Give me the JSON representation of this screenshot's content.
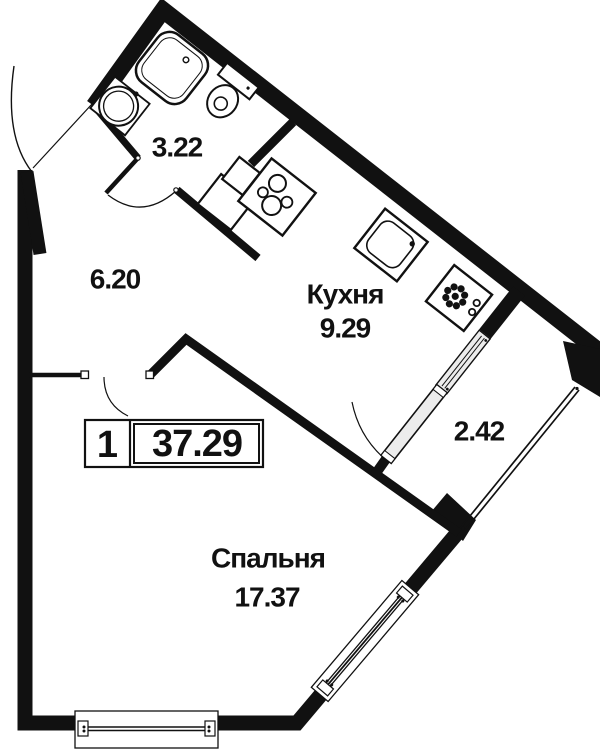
{
  "floorplan": {
    "unit_box": {
      "rooms_count": "1",
      "total_area": "37.29"
    },
    "rooms": [
      {
        "key": "bathroom",
        "area": "3.22"
      },
      {
        "key": "hallway",
        "area": "6.20"
      },
      {
        "key": "kitchen",
        "name": "Кухня",
        "area": "9.29"
      },
      {
        "key": "loggia",
        "area": "2.42"
      },
      {
        "key": "bedroom",
        "name": "Спальня",
        "area": "17.37"
      }
    ],
    "colors": {
      "wall": "#111111",
      "background": "#ffffff",
      "glazing_fill": "#ececec"
    }
  }
}
